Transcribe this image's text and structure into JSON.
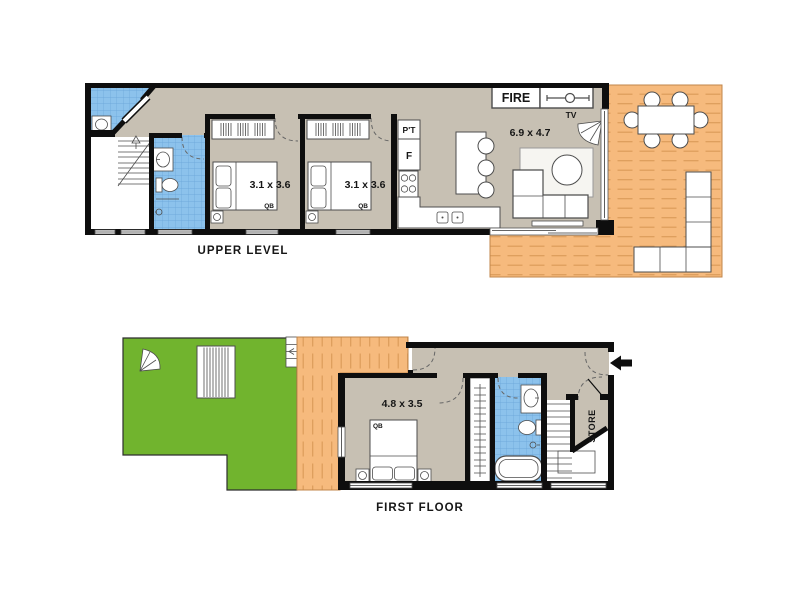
{
  "palette": {
    "wall": "#0e0e0e",
    "floor": "#c7c0b3",
    "deck": "#f6ba7d",
    "deck_line": "#dc9c5a",
    "lawn": "#71b42e",
    "tile": "#8cc2ec",
    "tile_line": "#68a4d8"
  },
  "upper_level": {
    "label": "UPPER LEVEL",
    "bedroom1": {
      "dim": "3.1 x 3.6",
      "bed": "QB"
    },
    "bedroom2": {
      "dim": "3.1 x 3.6",
      "bed": "QB"
    },
    "living": {
      "dim": "6.9 x 4.7",
      "tv": "TV"
    },
    "fireplace": {
      "label": "FIRE"
    },
    "kitchen": {
      "pantry": "P'T",
      "fridge": "F"
    }
  },
  "first_floor": {
    "label": "FIRST FLOOR",
    "bedroom": {
      "dim": "4.8 x 3.5",
      "bed": "QB"
    },
    "store": {
      "label": "STORE"
    }
  }
}
